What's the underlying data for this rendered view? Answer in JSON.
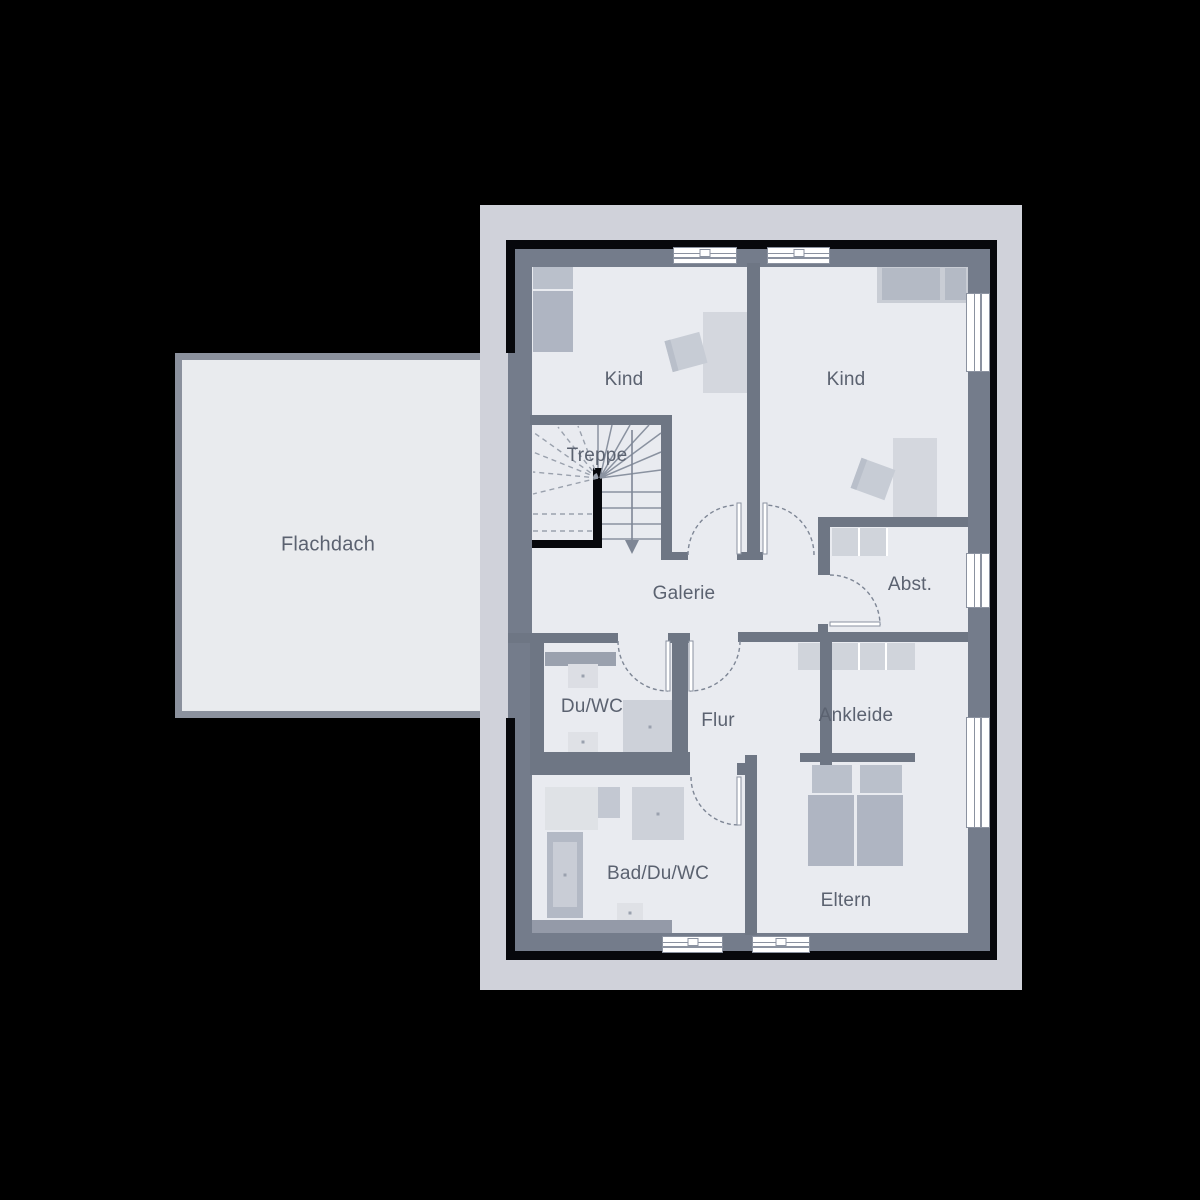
{
  "plan": {
    "type": "floor-plan-upper-storey",
    "rooms": [
      {
        "id": "flachdach",
        "label": "Flachdach"
      },
      {
        "id": "kind-left",
        "label": "Kind"
      },
      {
        "id": "kind-right",
        "label": "Kind"
      },
      {
        "id": "treppe",
        "label": "Treppe"
      },
      {
        "id": "galerie",
        "label": "Galerie"
      },
      {
        "id": "abstellraum",
        "label": "Abst."
      },
      {
        "id": "du-wc",
        "label": "Du/WC"
      },
      {
        "id": "flur",
        "label": "Flur"
      },
      {
        "id": "ankleide",
        "label": "Ankleide"
      },
      {
        "id": "bad-du-wc",
        "label": "Bad/Du/WC"
      },
      {
        "id": "eltern",
        "label": "Eltern"
      }
    ],
    "colors": {
      "background": "#000000",
      "surround_band": "#d0d2da",
      "floor": "#e9ebf0",
      "outer_wall": "#747c8b",
      "interior_wall": "#6e7684",
      "accent_black": "#07080c",
      "flat_roof_fill": "#e9ebee",
      "flat_roof_border": "#8b919d",
      "furniture_light": "#d4d7de",
      "furniture_mid": "#afb5c2",
      "label_text": "#5b6270",
      "window": "#ffffff"
    }
  }
}
